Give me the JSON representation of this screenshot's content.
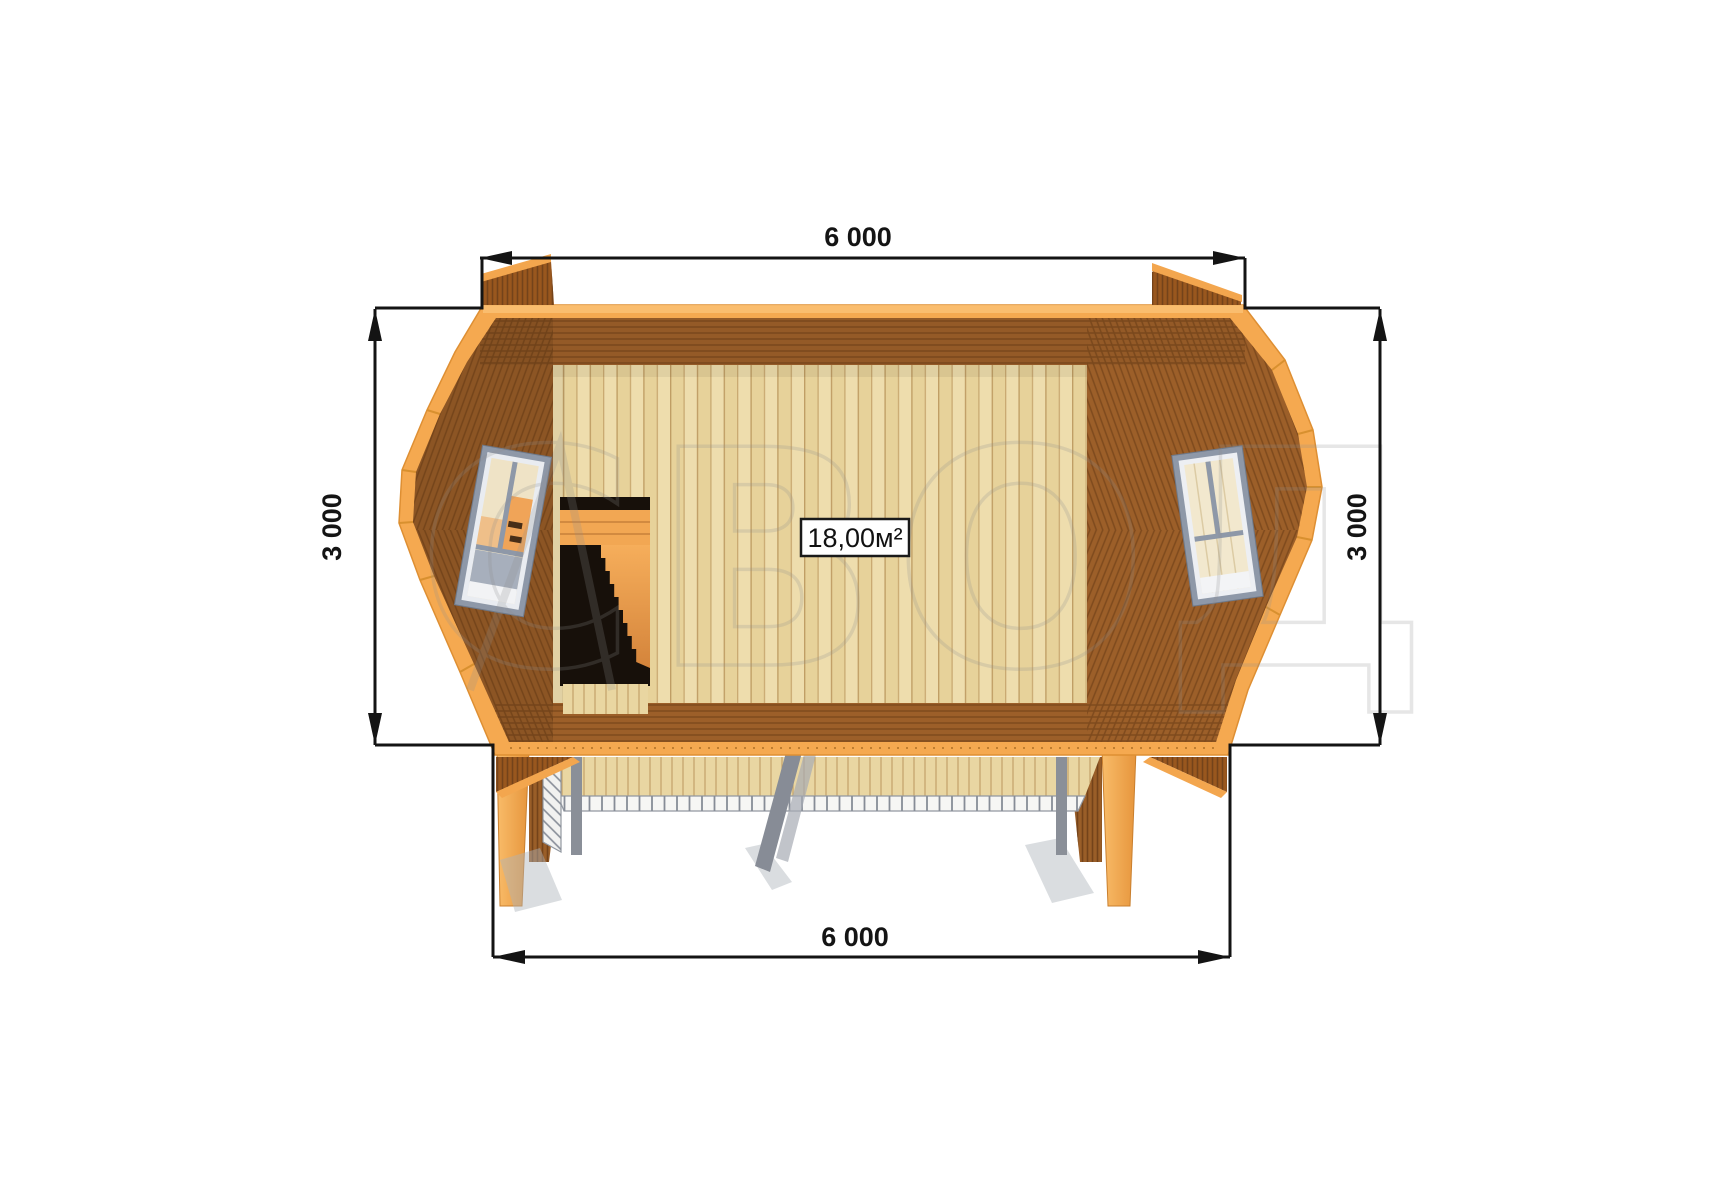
{
  "watermark": {
    "text": "СВОД"
  },
  "area_label": {
    "text": "18,00м²"
  },
  "dimensions": {
    "top": {
      "label": "6 000"
    },
    "bottom": {
      "label": "6 000"
    },
    "left": {
      "label": "3 000"
    },
    "right": {
      "label": "3 000"
    }
  },
  "diagram": {
    "type": "floor-plan-top-view",
    "width_label": "6 000",
    "depth_label": "3 000",
    "room_area_label": "18,00м²"
  },
  "palette": {
    "edge_orange": "#F5A950",
    "wall_brown": "#9C5F29",
    "floor_tan": "#EAD7A3",
    "window_gray": "#8E98A8",
    "railing_gray": "#8A8F98",
    "dimension_black": "#141414",
    "watermark_gray": "#8F8F8F",
    "background": "#FFFFFF"
  }
}
